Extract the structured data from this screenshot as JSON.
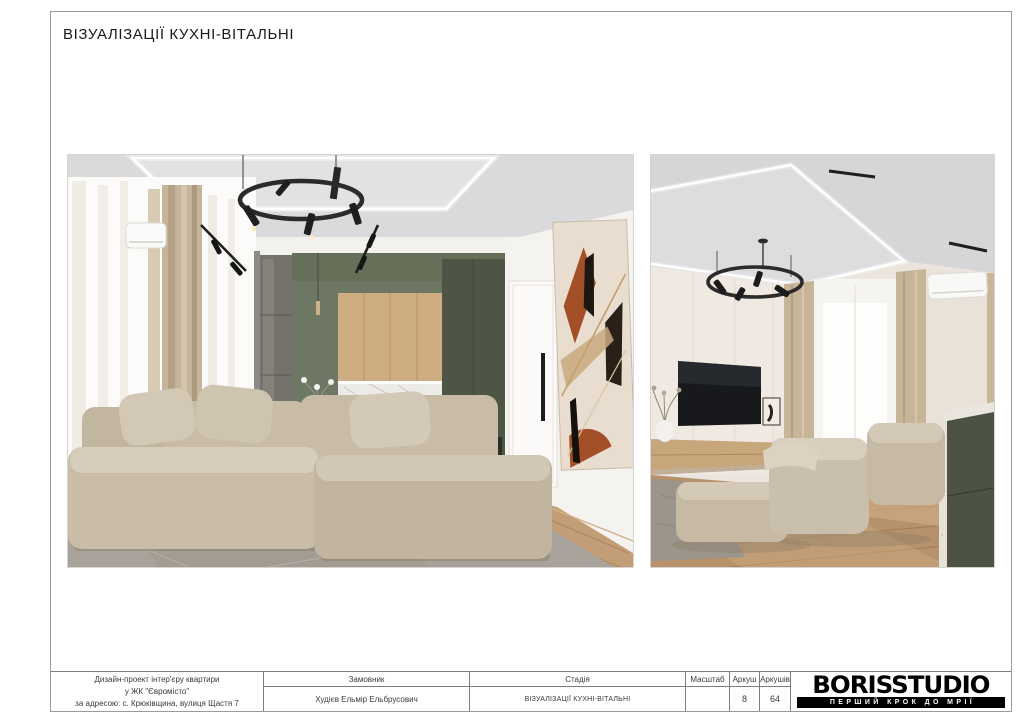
{
  "page": {
    "title": "ВІЗУАЛІЗАЦІЇ КУХНІ-ВІТАЛЬНІ"
  },
  "renders": {
    "left_alt": "Рендер кухні-вітальні: зелена кухня, дерев'яні фасади, бежевий модульний диван, кругла чорна люстра, абстрактна картина",
    "right_alt": "Рендер вітальні: ТВ-зона, бежевий диван, вікно зі шторами, кондиціонер, зелений кухонний острів"
  },
  "title_block": {
    "project": {
      "line1": "Дизайн-проект інтер'єру квартири",
      "line2": "у ЖК \"Євромісто\"",
      "line3": "за адресою: с. Крюківщина, вулиця Щастя 7"
    },
    "customer": {
      "header": "Замовник",
      "value": "Худієв Ельмір Ельбрусович"
    },
    "stage": {
      "header": "Стадія",
      "value": "ВІЗУАЛІЗАЦІЇ КУХНІ-ВІТАЛЬНІ"
    },
    "scale": {
      "header": "Масштаб",
      "value": ""
    },
    "sheet": {
      "header": "Аркуш",
      "value": "8"
    },
    "sheets_total": {
      "header": "Аркушів",
      "value": "64"
    },
    "logo": {
      "name": "BORISSTUDIO",
      "tagline": "ПЕРШИЙ КРОК ДО МРІЇ"
    }
  },
  "colors": {
    "cabinet_green": "#5d6751",
    "cabinet_green_dark": "#4e5545",
    "wood_oak": "#cfad82",
    "floor_wood": "#bb9770",
    "sofa_beige": "#c8bca7",
    "rug_gray": "#a8a29a",
    "frame_border": "#9b9b9b",
    "table_border": "#7d7d7d",
    "art_rust": "#a34f28"
  }
}
